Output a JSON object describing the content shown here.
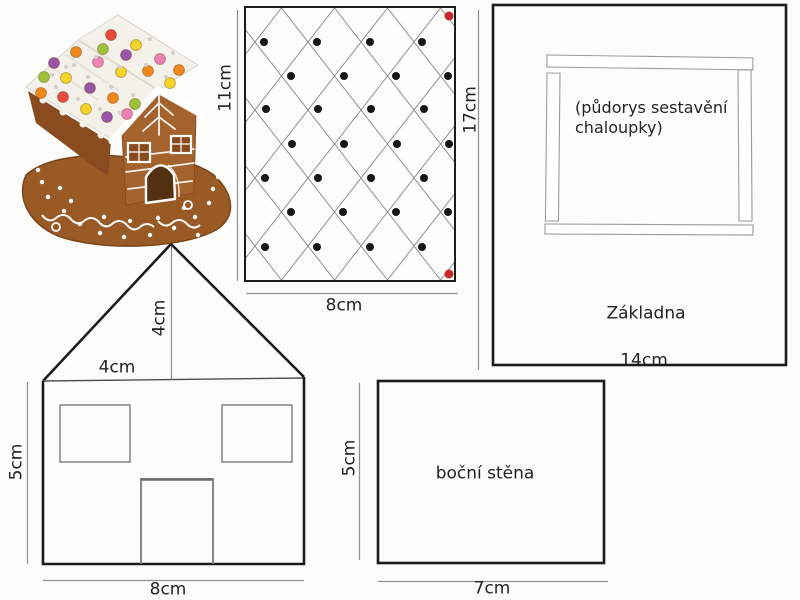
{
  "sheet": {
    "background": "#fcfcfa",
    "ink_color": "#1b1b1b",
    "dim_line_color": "#8f8f8f"
  },
  "photo": {
    "colors": {
      "gingerbread": "#a4622c",
      "gingerbread_dark": "#8a4b1e",
      "icing": "#f4f1ea",
      "base_plate": "#9a5a26",
      "pearl": "#d2cfca"
    },
    "candies": [
      [
        46,
        58,
        "#9a55a8"
      ],
      [
        68,
        47,
        "#f0871c"
      ],
      [
        90,
        57,
        "#ef7fb6"
      ],
      [
        113,
        67,
        "#f6d327"
      ],
      [
        58,
        73,
        "#f6d327"
      ],
      [
        82,
        83,
        "#9a55a8"
      ],
      [
        105,
        93,
        "#f0871c"
      ],
      [
        127,
        99,
        "#9fc03a"
      ],
      [
        36,
        72,
        "#9fc03a"
      ],
      [
        55,
        92,
        "#e54a3a"
      ],
      [
        78,
        104,
        "#f6d327"
      ],
      [
        99,
        112,
        "#9a55a8"
      ],
      [
        33,
        88,
        "#f0871c"
      ],
      [
        119,
        109,
        "#ef7fb6"
      ],
      [
        103,
        30,
        "#e54a3a"
      ],
      [
        128,
        40,
        "#f6d327"
      ],
      [
        152,
        54,
        "#ef7fb6"
      ],
      [
        171,
        65,
        "#f0871c"
      ],
      [
        95,
        44,
        "#9fc03a"
      ],
      [
        118,
        50,
        "#9a55a8"
      ],
      [
        140,
        66,
        "#f0871c"
      ],
      [
        162,
        78,
        "#f6d327"
      ]
    ],
    "pearls": [
      [
        58,
        62
      ],
      [
        80,
        72
      ],
      [
        103,
        82
      ],
      [
        125,
        90
      ],
      [
        48,
        82
      ],
      [
        70,
        94
      ],
      [
        92,
        104
      ],
      [
        112,
        108
      ],
      [
        88,
        52
      ],
      [
        112,
        62
      ],
      [
        138,
        60
      ],
      [
        158,
        72
      ],
      [
        142,
        34
      ],
      [
        165,
        48
      ],
      [
        44,
        70
      ],
      [
        66,
        60
      ]
    ],
    "base_dots": [
      [
        40,
        192
      ],
      [
        56,
        206
      ],
      [
        72,
        219
      ],
      [
        92,
        228
      ],
      [
        116,
        232
      ],
      [
        142,
        230
      ],
      [
        166,
        223
      ],
      [
        187,
        212
      ],
      [
        201,
        198
      ],
      [
        34,
        177
      ],
      [
        205,
        184
      ],
      [
        52,
        183
      ],
      [
        96,
        212
      ],
      [
        122,
        216
      ],
      [
        150,
        213
      ],
      [
        176,
        203
      ],
      [
        63,
        196
      ],
      [
        30,
        165
      ],
      [
        210,
        172
      ],
      [
        190,
        230
      ]
    ]
  },
  "roof_piece": {
    "dim_left": "11cm",
    "dim_right": "17cm",
    "dim_bottom": "8cm",
    "lattice_line_color": "#8e8e8e",
    "dot_color": "#161616",
    "corner_dot_color": "#c62b2b",
    "dots": [
      [
        18,
        34
      ],
      [
        71,
        34
      ],
      [
        124,
        34
      ],
      [
        176,
        34
      ],
      [
        45,
        68
      ],
      [
        98,
        68
      ],
      [
        150,
        68
      ],
      [
        202,
        68
      ],
      [
        20,
        101
      ],
      [
        72,
        101
      ],
      [
        125,
        101
      ],
      [
        178,
        101
      ],
      [
        46,
        136
      ],
      [
        98,
        136
      ],
      [
        151,
        136
      ],
      [
        203,
        136
      ],
      [
        19,
        170
      ],
      [
        72,
        170
      ],
      [
        125,
        170
      ],
      [
        178,
        170
      ],
      [
        45,
        204
      ],
      [
        97,
        204
      ],
      [
        150,
        204
      ],
      [
        202,
        204
      ],
      [
        19,
        239
      ],
      [
        71,
        239
      ],
      [
        124,
        239
      ],
      [
        176,
        239
      ]
    ],
    "corner_dots": [
      [
        203,
        8
      ],
      [
        203,
        266
      ]
    ]
  },
  "base_piece": {
    "note_lines": [
      "(půdorys sestavění",
      "chaloupky)"
    ],
    "label": "Základna",
    "dim_bottom": "14cm"
  },
  "front_wall_piece": {
    "dim_gable_height": "4cm",
    "dim_top_width": "4cm",
    "dim_side": "5cm",
    "dim_bottom": "8cm"
  },
  "side_wall_piece": {
    "label": "boční stěna",
    "dim_side": "5cm",
    "dim_bottom": "7cm"
  }
}
